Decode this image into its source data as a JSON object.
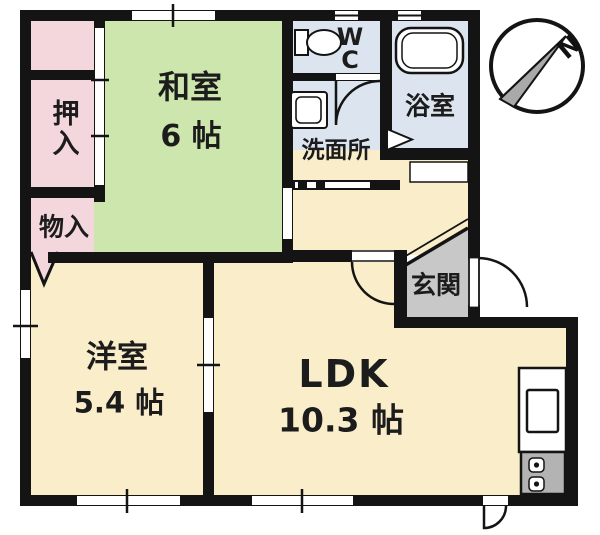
{
  "plan": {
    "type": "apartment-floorplan",
    "rooms": {
      "washitsu": {
        "name": "和室",
        "size": "6 帖"
      },
      "yoshitsu": {
        "name": "洋室",
        "size": "5.4 帖"
      },
      "ldk": {
        "name": "LDK",
        "size": "10.3 帖"
      },
      "genkan": {
        "name": "玄関"
      },
      "senmenjo": {
        "name": "洗面所"
      },
      "yokushitsu": {
        "name": "浴室"
      },
      "wc": {
        "line1": "W",
        "line2": "C"
      },
      "oshiire": {
        "name": "押入"
      },
      "monoire": {
        "name": "物入"
      }
    },
    "compass": {
      "label": "N",
      "direction": "north-pointing-upper-right"
    },
    "icons": [
      "toilet-icon",
      "bathtub-icon",
      "washing-machine-icon",
      "kitchen-sink-icon",
      "stove-burners-icon",
      "compass-icon",
      "door-swing-icon",
      "folding-door-icon"
    ],
    "colors": {
      "tatami_green": "#cde6ad",
      "flooring_cream": "#f9edca",
      "closet_pink": "#f3d7dd",
      "wet_area_blue": "#dce5ef",
      "genkan_gray": "#c8c8c8",
      "wall_black": "#141414",
      "stove_gray": "#b3b3b3"
    }
  }
}
